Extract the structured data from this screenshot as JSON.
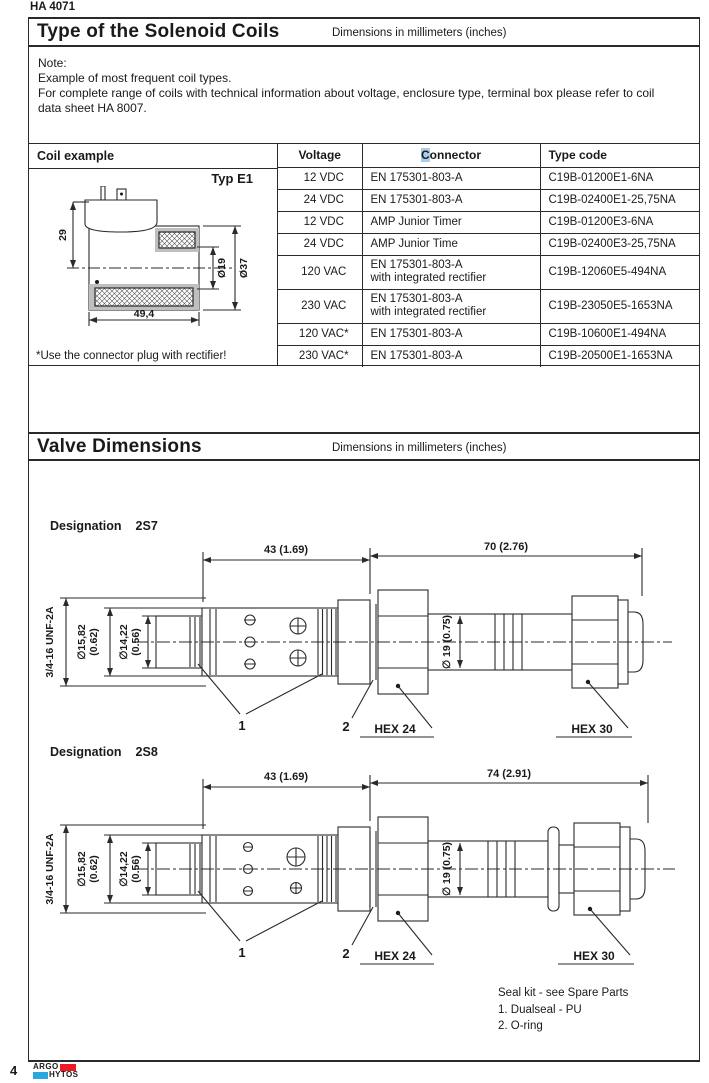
{
  "page": {
    "doc_code": "HA 4071",
    "page_number": "4",
    "logo": {
      "top": "ARGO",
      "bottom": "HYTOS",
      "red": "#ed1c24",
      "blue": "#29a8e0"
    }
  },
  "coils_section": {
    "title": "Type of the Solenoid Coils",
    "units": "Dimensions in millimeters (inches)",
    "note_lines": [
      "Note:",
      "Example of most frequent coil types.",
      "For complete range of  coils with technical information about voltage, enclosure type, terminal box please refer to coil",
      "data sheet HA 8007."
    ],
    "coil_example": {
      "header": "Coil example",
      "type_label": "Typ E1",
      "dim_height": "29",
      "dim_length": "49,4",
      "dim_inner": "Ø19",
      "dim_outer": "Ø37",
      "footnote": "*Use the connector plug with rectifier!"
    },
    "table": {
      "header": {
        "voltage": "Voltage",
        "connector_hl": "C",
        "connector_rest": "onnector",
        "type_code": "Type code",
        "highlight_color": "#aacdec"
      },
      "rows": [
        {
          "voltage": "12 VDC",
          "connector": "EN 175301-803-A",
          "connector2": "",
          "type_code": "C19B-01200E1-6NA"
        },
        {
          "voltage": "24 VDC",
          "connector": "EN 175301-803-A",
          "connector2": "",
          "type_code": "C19B-02400E1-25,75NA"
        },
        {
          "voltage": "12 VDC",
          "connector": "AMP Junior Timer",
          "connector2": "",
          "type_code": "C19B-01200E3-6NA"
        },
        {
          "voltage": "24 VDC",
          "connector": "AMP Junior Time",
          "connector2": "",
          "type_code": "C19B-02400E3-25,75NA"
        },
        {
          "voltage": "120 VAC",
          "connector": "EN 175301-803-A",
          "connector2": "with integrated rectifier",
          "type_code": "C19B-12060E5-494NA"
        },
        {
          "voltage": "230 VAC",
          "connector": "EN 175301-803-A",
          "connector2": "with integrated rectifier",
          "type_code": "C19B-23050E5-1653NA"
        },
        {
          "voltage": "120 VAC*",
          "connector": "EN 175301-803-A",
          "connector2": "",
          "type_code": "C19B-10600E1-494NA"
        },
        {
          "voltage": "230 VAC*",
          "connector": "EN 175301-803-A",
          "connector2": "",
          "type_code": "C19B-20500E1-1653NA"
        }
      ]
    }
  },
  "valves_section": {
    "title": "Valve Dimensions",
    "units": "Dimensions in millimeters (inches)",
    "drawings": [
      {
        "designation": "Designation",
        "code": "2S7",
        "dim_front": "43 (1.69)",
        "dim_total": "70 (2.76)",
        "thread": "3/4-16 UNF-2A",
        "dia1_mm": "∅15,82",
        "dia1_in": "(0.62)",
        "dia2_mm": "∅14,22",
        "dia2_in": "(0.56)",
        "dia_body": "∅ 19 (0.75)",
        "callout_seal": "1",
        "callout_oring": "2",
        "hex_nut": "HEX 24",
        "hex_end": "HEX 30"
      },
      {
        "designation": "Designation",
        "code": "2S8",
        "dim_front": "43 (1.69)",
        "dim_total": "74 (2.91)",
        "thread": "3/4-16 UNF-2A",
        "dia1_mm": "∅15,82",
        "dia1_in": "(0.62)",
        "dia2_mm": "∅14,22",
        "dia2_in": "(0.56)",
        "dia_body": "∅ 19 (0.75)",
        "callout_seal": "1",
        "callout_oring": "2",
        "hex_nut": "HEX 24",
        "hex_end": "HEX 30"
      }
    ],
    "seal_note": [
      "Seal kit - see Spare Parts",
      "1. Dualseal - PU",
      "2. O-ring"
    ]
  }
}
